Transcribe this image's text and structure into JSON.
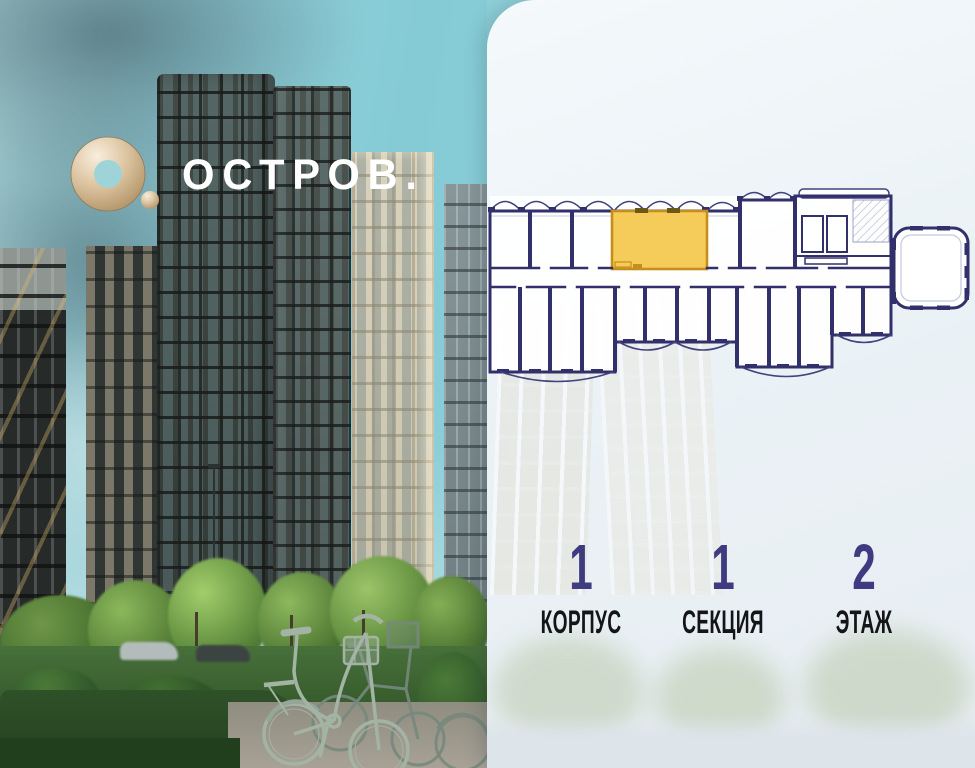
{
  "brand": {
    "symbol": "О.",
    "wordmark": "ОСТРОВ."
  },
  "floorplan": {
    "description": "floor plan with one highlighted apartment",
    "highlight_color": "#F2C94C",
    "highlight_border": "#C68F1D",
    "wall_color": "#32306B"
  },
  "stats": {
    "items": [
      {
        "value": "1",
        "label": "КОРПУС"
      },
      {
        "value": "1",
        "label": "СЕКЦИЯ"
      },
      {
        "value": "2",
        "label": "ЭТАЖ"
      }
    ]
  },
  "colors": {
    "stat_number": "#3E3B80",
    "stat_label": "#141518",
    "panel_background": "#EDF3F7",
    "sky": "#8ECFD8",
    "logo_gold": "#D9C09B"
  }
}
